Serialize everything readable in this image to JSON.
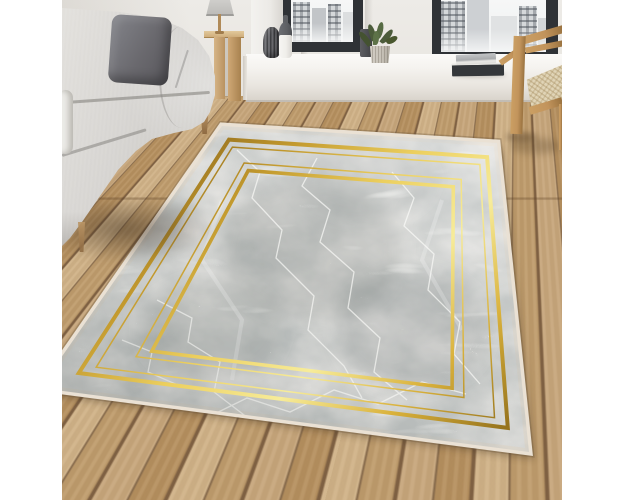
{
  "image": {
    "type": "product-lifestyle-photo",
    "subject": "Grey marble-pattern area rug with double gold frame border, styled in a living room with grey sofa, oak floor, window seat and wooden chair",
    "canvas": {
      "width": 625,
      "height": 500
    },
    "photo_rect": {
      "left": 62,
      "top": 0,
      "width": 500,
      "height": 500
    }
  },
  "palette": {
    "page_bg": "#ffffff",
    "wall": "#edebe7",
    "wall_shade": "#e1ded8",
    "floor_a": "#c7a67b",
    "floor_b": "#b6905f",
    "floor_c": "#d0b287",
    "floor_d": "#bf9c6c",
    "floor_gap": "#7c5f3f",
    "window_frame": "#2f3236",
    "glass": "#f6f7f7",
    "building": "#c9cccf",
    "sill": "#f4f2ee",
    "sill_front": "#e9e5df",
    "sofa": "#d7d5d2",
    "sofa_light": "#e3e1dd",
    "sofa_dark": "#bfbdb9",
    "pillow": "#6a696e",
    "wood": "#c2945c",
    "wood_dark": "#9a7340",
    "cane": "#e0d4b6",
    "plant": "#4c5c3b",
    "pot": "#c6c1b7",
    "vase_dark": "#56575b",
    "bottle_top": "#5e6064",
    "bottle_body": "#efeeea",
    "book_dark": "#34373a",
    "book_light": "#c3c5c7",
    "fringe": "#eae1d4",
    "marble_base": "#e6e5e2",
    "gold": "#d4af37",
    "shadow": "#3c2d1e"
  },
  "rug": {
    "quad": [
      [
        160,
        126
      ],
      [
        435,
        143
      ],
      [
        467,
        452
      ],
      [
        -22,
        388
      ]
    ],
    "fringe_width": 7,
    "rim_width": 10,
    "shadow_offset": [
      5,
      7
    ],
    "gold_stops": [
      "#8a651a",
      "#c39a2e",
      "#eccf5e",
      "#f7ec9a",
      "#d9b13b",
      "#96731d"
    ],
    "frames": [
      {
        "u": [
          0.055,
          0.96
        ],
        "v": [
          0.048,
          0.93
        ],
        "w": 4.0
      },
      {
        "u": [
          0.082,
          0.933
        ],
        "v": [
          0.074,
          0.902
        ],
        "w": 1.5
      },
      {
        "u": [
          0.15,
          0.868
        ],
        "v": [
          0.128,
          0.848
        ],
        "w": 1.5
      },
      {
        "u": [
          0.176,
          0.842
        ],
        "v": [
          0.154,
          0.822
        ],
        "w": 3.6
      }
    ],
    "marble": {
      "freq": "0.017 0.022",
      "octaves": 4,
      "seed": 11,
      "opacity": 0.8,
      "vein_freq": "0.011 0.05",
      "vein_octaves": 2,
      "vein_seed": 7,
      "vein_opacity": 0.85
    },
    "patches": [
      {
        "cx": 250,
        "cy": 250,
        "rx": 90,
        "ry": 70,
        "o": 0.28
      },
      {
        "cx": 150,
        "cy": 330,
        "rx": 70,
        "ry": 50,
        "o": 0.22
      },
      {
        "cx": 350,
        "cy": 330,
        "rx": 75,
        "ry": 60,
        "o": 0.25
      },
      {
        "cx": 300,
        "cy": 180,
        "rx": 70,
        "ry": 40,
        "o": 0.2
      }
    ],
    "veins": [
      "M175,150 L198,172 L190,198 L220,230 L214,258 L252,296 L246,330 L282,366 L300,398",
      "M255,158 L240,186 L268,210 L258,242 L292,272 L286,308 L318,338 L312,372 L345,400",
      "M330,172 L352,198 L342,226 L372,254 L366,290 L398,322 L392,354 L418,384",
      "M95,300 L130,318 L126,342 L158,362 L152,392 L186,418",
      "M140,420 L185,398 L228,412 L272,390 L316,404 L360,382 L404,394",
      "M60,340 L90,352 L86,372 L118,386"
    ],
    "soft_veins": [
      "M160,200 L140,260 L180,320 L170,380",
      "M380,200 L360,260 L400,330"
    ]
  }
}
